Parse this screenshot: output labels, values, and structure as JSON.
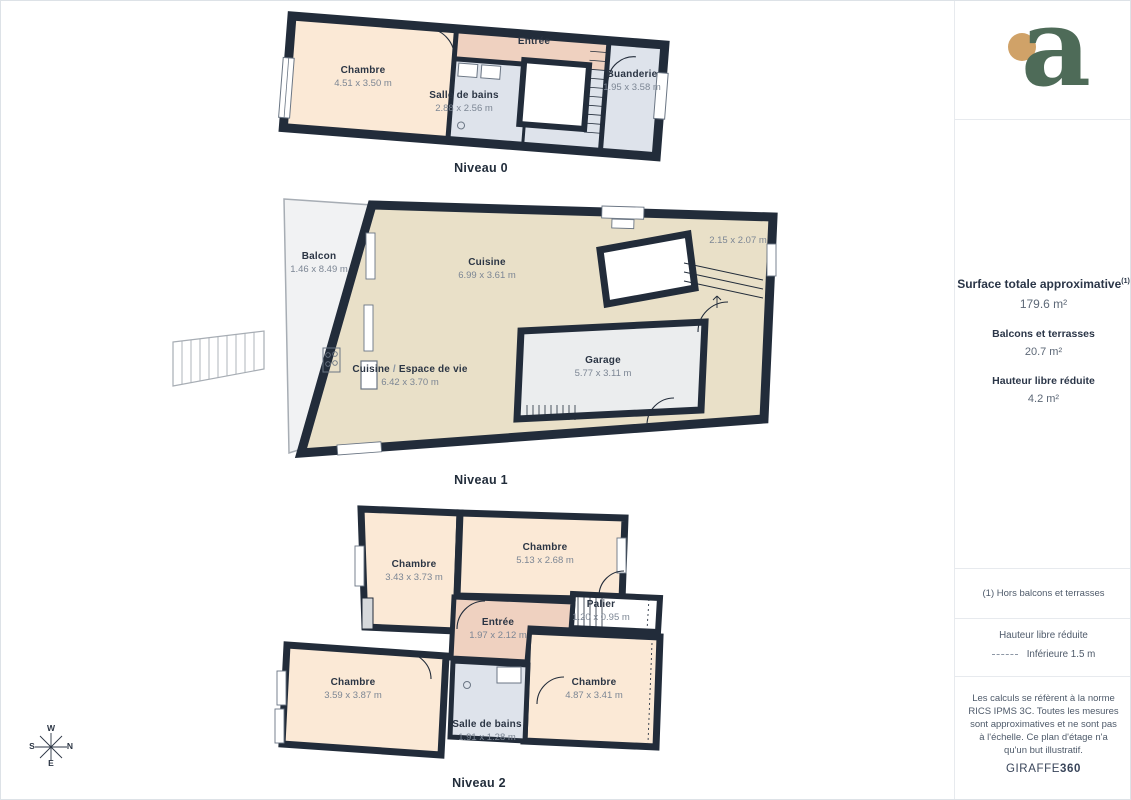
{
  "logo": {
    "letter": "a"
  },
  "floors": [
    {
      "label": "Niveau 0",
      "rooms": [
        {
          "name": "Chambre",
          "dims": "4.51 x 3.50 m"
        },
        {
          "name": "Entrée",
          "dims": ""
        },
        {
          "name": "Salle de bains",
          "dims": "2.88 x 2.56 m"
        },
        {
          "name": "Buanderie",
          "dims": "1.95 x 3.58 m"
        }
      ]
    },
    {
      "label": "Niveau 1",
      "rooms": [
        {
          "name": "Balcon",
          "dims": "1.46 x 8.49 m"
        },
        {
          "name": "Cuisine",
          "dims": "6.99 x 3.61 m"
        },
        {
          "name": "",
          "dims": "2.15 x 2.07 m"
        },
        {
          "name": "Cuisine",
          "slash": " / ",
          "name2": "Espace de vie",
          "dims": "6.42 x 3.70 m"
        },
        {
          "name": "Garage",
          "dims": "5.77 x 3.11 m"
        }
      ]
    },
    {
      "label": "Niveau 2",
      "rooms": [
        {
          "name": "Chambre",
          "dims": "3.43 x 3.73 m"
        },
        {
          "name": "Chambre",
          "dims": "5.13 x 2.68 m"
        },
        {
          "name": "Palier",
          "dims": "1.20 x 0.95 m"
        },
        {
          "name": "Entrée",
          "dims": "1.97 x 2.12 m"
        },
        {
          "name": "Chambre",
          "dims": "3.59 x 3.87 m"
        },
        {
          "name": "Chambre",
          "dims": "4.87 x 3.41 m"
        },
        {
          "name": "Salle de bains",
          "dims": "1.91 x 1.28 m"
        }
      ]
    }
  ],
  "sidebar": {
    "surface_title": "Surface totale approximative",
    "surface_footnote_marker": "(1)",
    "surface_value": "179.6 m²",
    "balconies_title": "Balcons et terrasses",
    "balconies_value": "20.7 m²",
    "reduced_height_title": "Hauteur libre réduite",
    "reduced_height_value": "4.2 m²",
    "footnote": "(1) Hors balcons et terrasses",
    "legend_title": "Hauteur libre réduite",
    "legend_item": "Inférieure 1.5 m",
    "disclaimer": "Les calculs se réfèrent à la norme RICS IPMS 3C. Toutes les mesures sont approximatives et ne sont pas à l'échelle. Ce plan d'étage n'a qu'un but illustratif.",
    "brand_name": "GIRAFFE",
    "brand_suffix": "360"
  },
  "compass": {
    "west": "W",
    "north": "N",
    "east": "E",
    "south": "S"
  },
  "colors": {
    "wall": "#222c3a",
    "bedroom": "#fbe9d6",
    "entry": "#efd1c0",
    "bathroom": "#dee3eb",
    "kitchen": "#e9e0c8",
    "garage": "#ebedee",
    "balcony": "#f1f2f3",
    "logo_green": "#4e6b58",
    "logo_gold": "#d0a268",
    "text_dark": "#2b3544",
    "text_muted": "#7c8694"
  }
}
